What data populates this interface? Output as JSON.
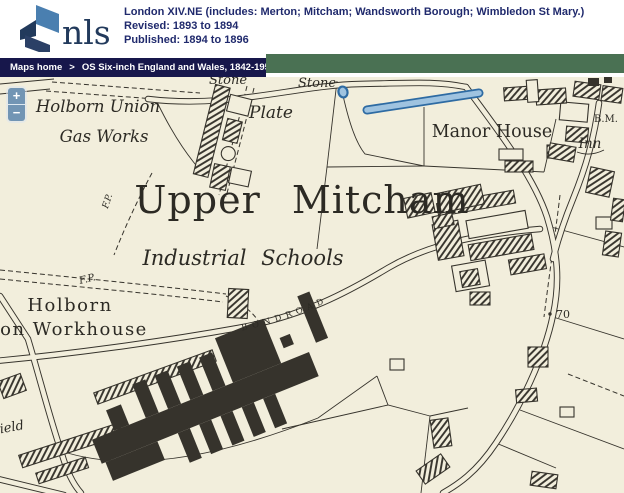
{
  "header": {
    "logo": "nls",
    "title": "London XIV.NE (includes: Merton; Mitcham; Wandsworth Borough; Wimbledon St Mary.)",
    "revised": "Revised: 1893 to 1894",
    "published": "Published: 1894 to 1896"
  },
  "breadcrumb": {
    "home": "Maps home",
    "separator": ">",
    "collection": "OS Six-inch England and Wales, 1842-1952"
  },
  "map_viewer": {
    "zoom_in": "+",
    "zoom_out": "−"
  },
  "map": {
    "labels": {
      "stone_a": "Stone",
      "stone_b": "Stone",
      "plate": "Plate",
      "gas_works_line1": "Holborn Union",
      "gas_works_line2": "Gas Works",
      "manor_house": "Manor House",
      "bench_mark": "B.M.",
      "inn": "Inn",
      "upper_mitcham": "Upper Mitcham",
      "industrial_schools": "Industrial Schools",
      "footpath_a": "F.P.",
      "footpath_b": "F.P.",
      "holborn": "Holborn",
      "workhouse": "on Workhouse",
      "bond_road": "B O N D      R O A D",
      "spot_height": "70",
      "field": "Field"
    },
    "colors": {
      "paper": "#f2eedc",
      "ink": "#36332c",
      "water_fill": "#9fc3e0",
      "water_edge": "#2e6ba3",
      "out_of_map_band": "#4a7153",
      "breadcrumb_bar": "#17174b",
      "header_text": "#202a6d",
      "logo_blue": "#4a7fb0",
      "logo_navy": "#223a5c",
      "zoom_control_blue": "#7295b4"
    }
  }
}
